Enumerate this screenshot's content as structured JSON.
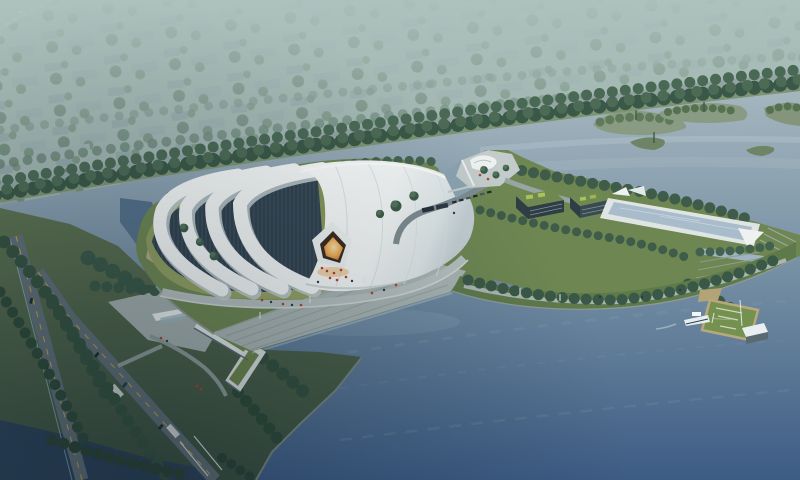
{
  "scene": {
    "title": "Aerial rendering of lakeside white membrane-roof venue at dusk",
    "view": "bird's-eye perspective from southwest",
    "time_of_day": "dusk, hazy",
    "palette": {
      "sky_top": "#aec1bc",
      "sky_horizon": "#9db3b1",
      "haze": "#aec3be",
      "city_block": "#95aaab",
      "city_block_far": "#9cafaf",
      "city_tree": "#6a8573",
      "boulevard_tree": "#3a5847",
      "boulevard_road": "#93a4a2",
      "water_far": "#a6b7bf",
      "water_mid": "#7791a5",
      "water_deep": "#3d5c84",
      "channel_water": "#2c4258",
      "island_green": "#5f7a58",
      "lawn": "#8a9b5c",
      "grass_dark": "#54694a",
      "peninsula_grass": "#6e8752",
      "roof_white": "#f3f6f5",
      "roof_shade": "#c2ced2",
      "rib_shadow": "#c3ced1",
      "glazing": "#31414d",
      "glow_core": "#fbe0a8",
      "glow_deep": "#a96524",
      "entrance_spill": "#eaa94f",
      "plaza": "#b6c0bf",
      "steps": "#a9b5b2",
      "promenade": "#aab6b2",
      "road": "#5f6d75",
      "road_line": "#c2a33c",
      "bike_lane": "#9fd4dd",
      "block_roof": "#6f8850",
      "block_panel": "#a9c25e",
      "block_facade": "#2f3d45",
      "pool_deck": "#dfe5e3",
      "pool_water": "#a9bccb",
      "pier_green": "#75914f",
      "pier_edge": "#b7a97c",
      "pavilion_white": "#e9eef0",
      "boat_white": "#e8eef0",
      "people_red": "#b7402e",
      "people_dark": "#2e3a40",
      "tree_dark": "#3e5c49",
      "tree_light": "#55735c",
      "embankment": "#8e9b94",
      "lbuilding_white": "#dfe6e4",
      "lbuilding_roof": "#71894f",
      "beach_sand": "#b5a98a"
    },
    "elements": {
      "main_venue": "large white ribbed membrane roof hall with glowing amber entrance",
      "waterfront_steps": "terraced steps descending to the lake",
      "l_building": "L-shaped white building with green roof and entry canopy",
      "green_roof_blocks": "two dark facade blocks with planted roofs on east peninsula",
      "reflecting_pool": "long rectangular pool with white deck",
      "causeway": "curved tree-lined promenade arcing through the lake",
      "pier": "green pier deck with white pavilion and moored boat",
      "islands": "small wooded islands in the river",
      "boulevard": "tree-lined riverside road",
      "distant_city": "hazy low-rise district among trees",
      "roads": "diagonal roads with yellow centerlines, cars and crosswalks"
    }
  }
}
